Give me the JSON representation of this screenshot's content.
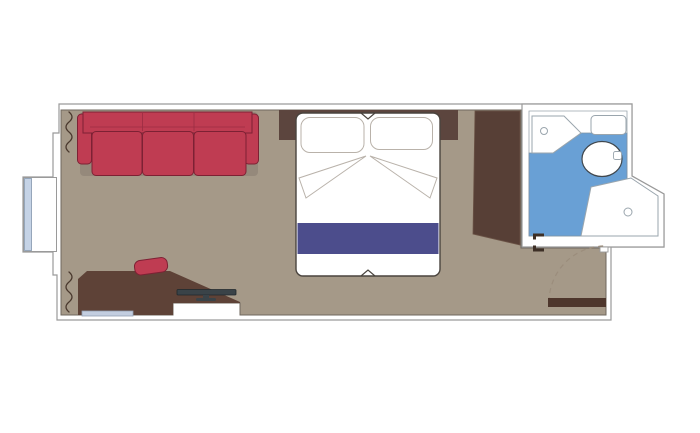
{
  "meta": {
    "type": "floorplan",
    "description": "Top-down floor plan of a ship cabin: living area with sofa, double bed, desk, wardrobe, en-suite bathroom with washbasin, toilet and shower, window bay on the left and entry door at bottom right"
  },
  "colors": {
    "background": "#ffffff",
    "wall_fill": "#ffffff",
    "wall_line": "#9a9a9a",
    "floor": "#a59988",
    "floor_line": "#6f675e",
    "shadow": "#95897b",
    "sofa": "#bf3c52",
    "sofa_line": "#7d2134",
    "chair": "#bf3c52",
    "desk": "#5e4237",
    "wardrobe": "#573f36",
    "headboard": "#5c453e",
    "entry_door": "#4e362c",
    "door_mark": "#3d2f26",
    "curtain": "#4a392e",
    "bed_fill": "#ffffff",
    "bed_line": "#4a443e",
    "pillow_line": "#b9b2aa",
    "bed_runner": "#4c4d8c",
    "bath_floor": "#69a0d5",
    "bath_edge": "#7f93a3",
    "fixture_line": "#9aa5ad",
    "toilet_line": "#40474d",
    "glass": "#c5d3e6",
    "glass_line": "#8296ad",
    "tv": "#3a4348",
    "ledge": "#c3cee0",
    "arc": "#9b8d7c"
  },
  "rooms": [
    {
      "name": "cabin-main-room"
    },
    {
      "name": "bathroom"
    },
    {
      "name": "window-bay"
    }
  ],
  "furniture": [
    {
      "name": "sofa",
      "seats": 3
    },
    {
      "name": "double-bed"
    },
    {
      "name": "pillow-left"
    },
    {
      "name": "pillow-right"
    },
    {
      "name": "bed-runner"
    },
    {
      "name": "headboard"
    },
    {
      "name": "wardrobe"
    },
    {
      "name": "desk"
    },
    {
      "name": "desk-chair"
    },
    {
      "name": "tv"
    },
    {
      "name": "ledge-shelf"
    },
    {
      "name": "washbasin"
    },
    {
      "name": "bathroom-shelf"
    },
    {
      "name": "toilet"
    },
    {
      "name": "shower"
    },
    {
      "name": "entry-door"
    },
    {
      "name": "bathroom-door-marks"
    },
    {
      "name": "curtains"
    },
    {
      "name": "window-glass"
    }
  ]
}
